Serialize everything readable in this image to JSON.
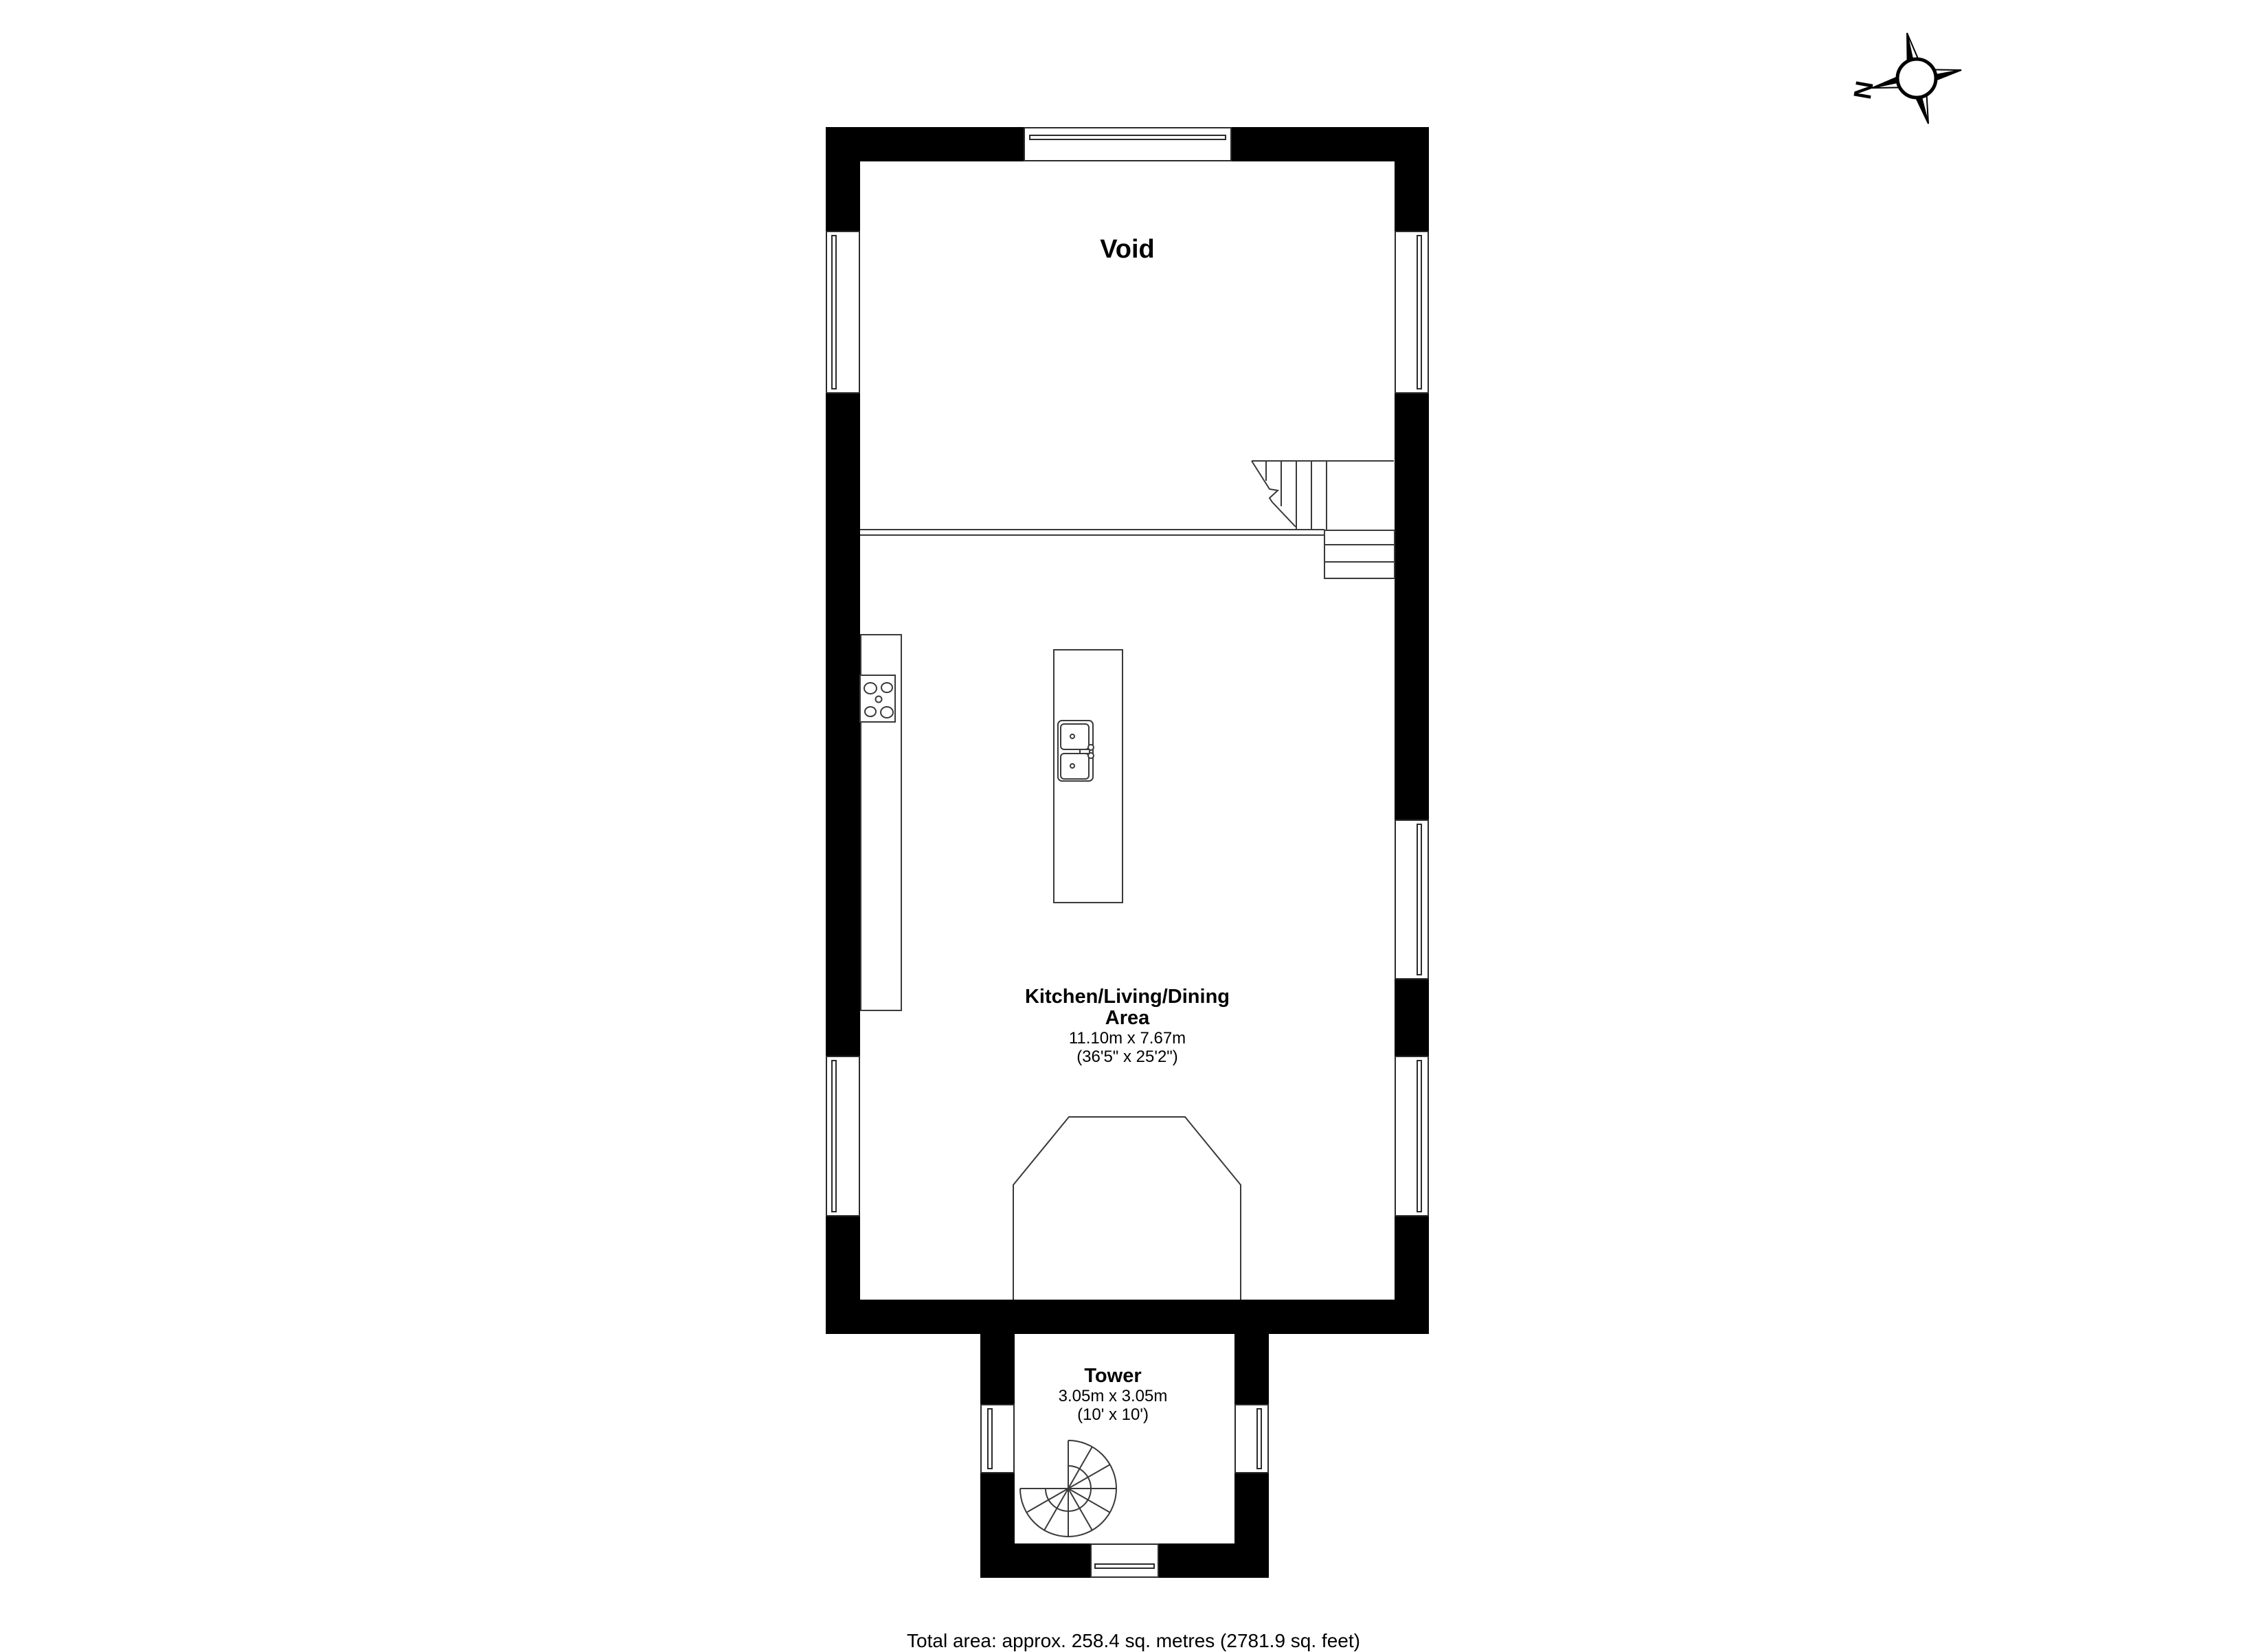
{
  "page": {
    "background": "#ffffff",
    "wall_color": "#000000",
    "line_color": "#3a3a3a"
  },
  "compass": {
    "north_label": "N"
  },
  "rooms": {
    "void": {
      "name": "Void"
    },
    "kitchen": {
      "name_line1": "Kitchen/Living/Dining",
      "name_line2": "Area",
      "dimensions_metric": "11.10m x 7.67m",
      "dimensions_imperial": "(36'5\" x 25'2\")"
    },
    "tower": {
      "name": "Tower",
      "dimensions_metric": "3.05m x 3.05m",
      "dimensions_imperial": "(10' x 10')"
    }
  },
  "footer": {
    "total_area": "Total area: approx. 258.4 sq. metres (2781.9 sq. feet)"
  }
}
